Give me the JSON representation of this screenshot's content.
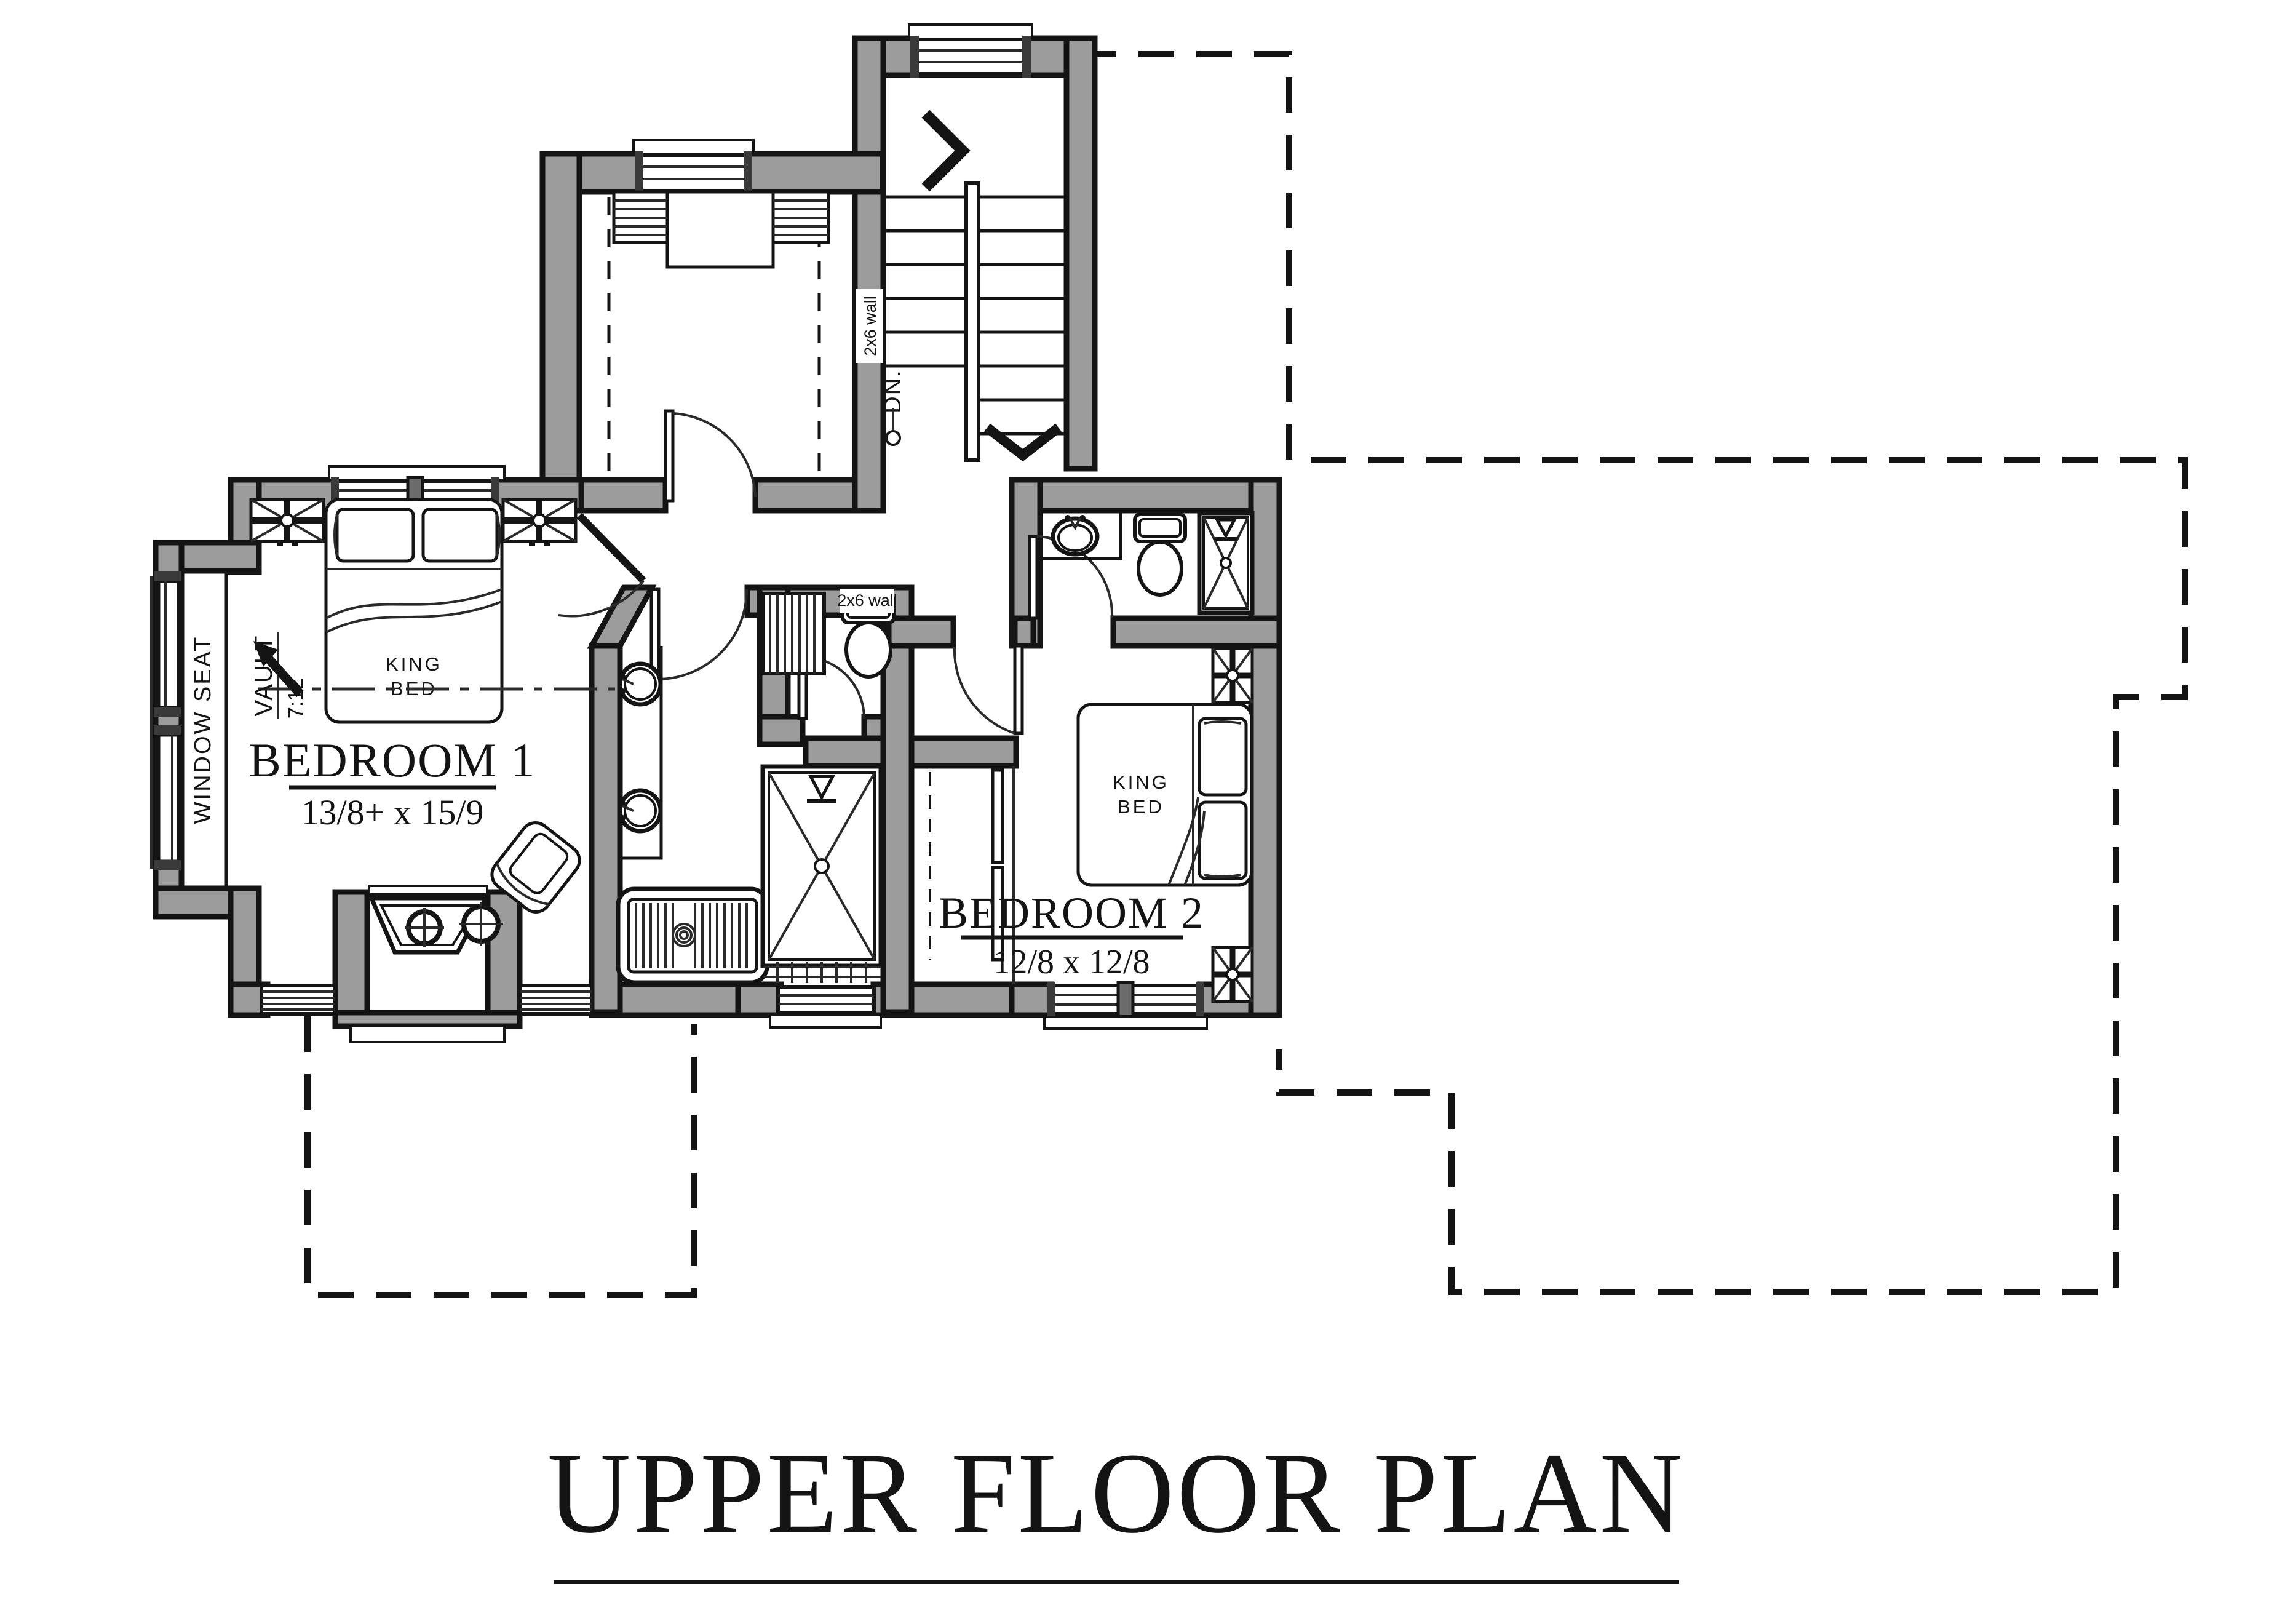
{
  "drawing": {
    "title": "UPPER FLOOR PLAN",
    "type": "architectural floor plan",
    "colors": {
      "paper": "#ffffff",
      "wall_fill": "#9c9c9c",
      "line": "#141414"
    }
  },
  "labels": {
    "bedroom1_name": "BEDROOM 1",
    "bedroom1_dims": "13/8+ x 15/9",
    "bedroom2_name": "BEDROOM 2",
    "bedroom2_dims": "12/8 x 12/8",
    "king_line1": "KING",
    "king_line2": "BED",
    "window_seat": "WINDOW SEAT",
    "vault": "VAULT",
    "vault_pitch": "7:12",
    "down": "DN.",
    "wall_note": "2x6 wall"
  }
}
